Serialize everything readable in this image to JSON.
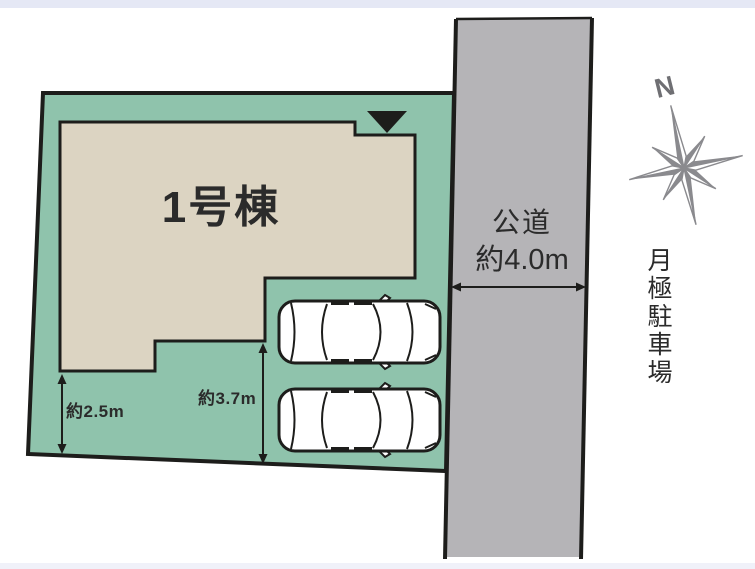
{
  "labels": {
    "building": "1号棟",
    "road_name": "公道",
    "road_width": "約4.0m",
    "setback_left": "約2.5m",
    "setback_front": "約3.7m",
    "north": "N",
    "adjacent_parking": "月極駐車場"
  },
  "icons": {
    "entrance_marker": "triangle-down-icon",
    "compass": "compass-rose-icon",
    "parking_spaces": "car-top-view-icon"
  },
  "colors": {
    "plot": "#8fc3ac",
    "building": "#dcd4c2",
    "road": "#b5b4b7",
    "outline": "#1d1d1b",
    "compass": "#8a8a8e",
    "text": "#2b2b2b",
    "top_bar": "#e5e8f5",
    "bottom_bar": "#f0f1f9"
  }
}
